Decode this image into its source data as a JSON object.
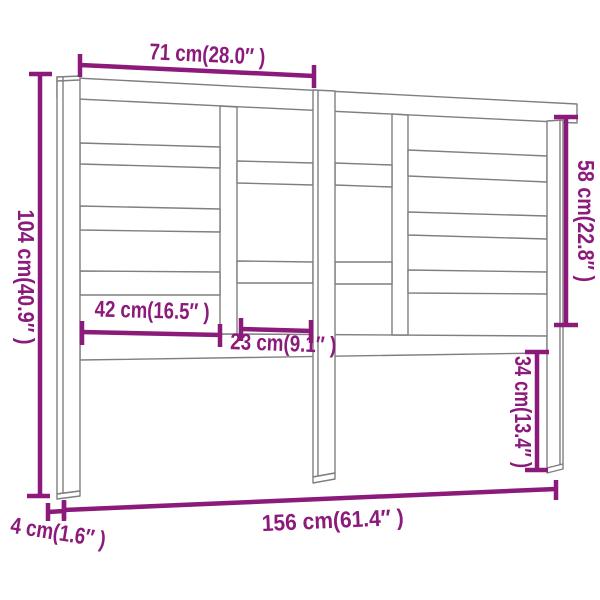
{
  "diagram": {
    "title": "Headboard dimension diagram",
    "colors": {
      "dimension": "#8C1A7B",
      "outline": "#7F7F7F",
      "background": "#FFFFFF"
    },
    "dimensions": {
      "top_span": "71 cm(28.0″ )",
      "overall_height": "104 cm(40.9″ )",
      "slat_section_height": "58 cm(22.8″ )",
      "left_section_width": "42 cm(16.5″ )",
      "center_section_width": "23 cm(9.1″ )",
      "leg_height": "34 cm(13.4″ )",
      "overall_width": "156 cm(61.4″ )",
      "thickness": "4 cm(1.6″ )"
    }
  }
}
